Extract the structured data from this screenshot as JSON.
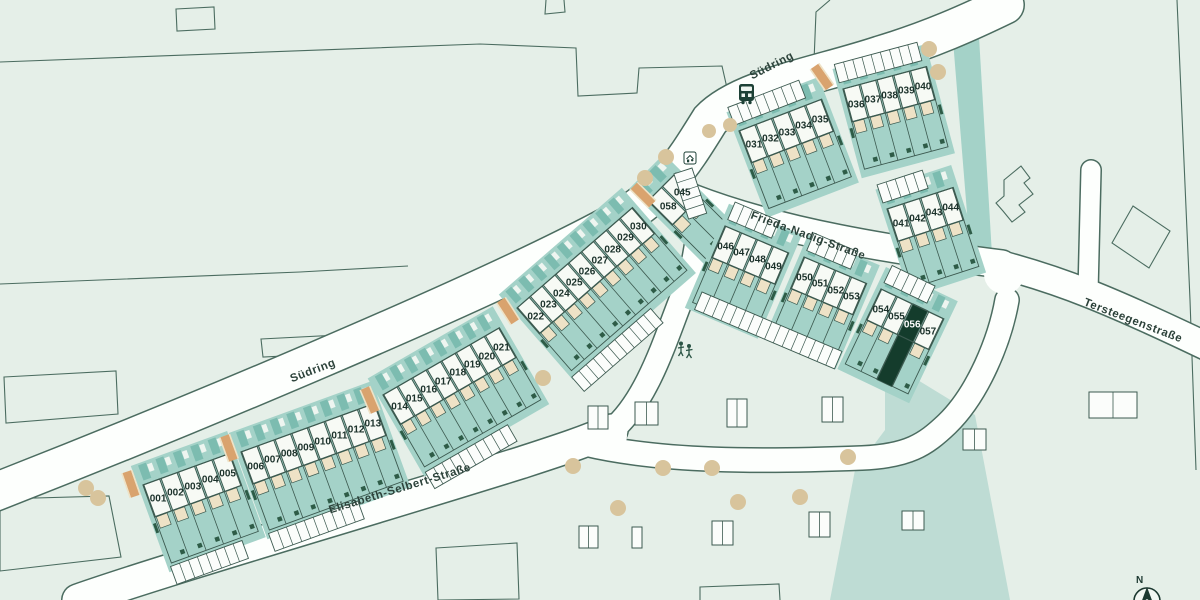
{
  "map": {
    "kind": "residential-site-plan"
  },
  "streets": [
    {
      "id": "suedring-west",
      "label": "Südring"
    },
    {
      "id": "suedring-north",
      "label": "Südring"
    },
    {
      "id": "elisabeth-selbert-strasse",
      "label": "Elisabeth-Selbert-Straße"
    },
    {
      "id": "frieda-nadig-strasse",
      "label": "Frieda-Nadig-Straße"
    },
    {
      "id": "tersteegenstrasse",
      "label": "Tersteegenstraße"
    }
  ],
  "blocks": [
    {
      "id": "block-a",
      "plots": [
        "001",
        "002",
        "003",
        "004",
        "005"
      ]
    },
    {
      "id": "block-b",
      "plots": [
        "006",
        "007",
        "008",
        "009",
        "010",
        "011",
        "012",
        "013"
      ]
    },
    {
      "id": "block-c",
      "plots": [
        "014",
        "015",
        "016",
        "017",
        "018",
        "019",
        "020",
        "021"
      ]
    },
    {
      "id": "block-d",
      "plots": [
        "022",
        "023",
        "024",
        "025",
        "026",
        "027",
        "028",
        "029",
        "030"
      ]
    },
    {
      "id": "block-e",
      "plots": [
        "058",
        "045"
      ]
    },
    {
      "id": "block-f",
      "plots": [
        "031",
        "032",
        "033",
        "034",
        "035"
      ]
    },
    {
      "id": "block-g",
      "plots": [
        "036",
        "037",
        "038",
        "039",
        "040"
      ]
    },
    {
      "id": "block-h",
      "plots": [
        "041",
        "042",
        "043",
        "044"
      ]
    },
    {
      "id": "block-i",
      "plots": [
        "046",
        "047",
        "048",
        "049"
      ]
    },
    {
      "id": "block-j",
      "plots": [
        "050",
        "051",
        "052",
        "053"
      ]
    },
    {
      "id": "block-k",
      "plots": [
        "054",
        "055",
        "056",
        "057"
      ]
    }
  ],
  "highlighted_plot": "056",
  "compass": {
    "label": "N"
  },
  "icons": [
    {
      "id": "bus-stop-icon"
    },
    {
      "id": "play-street-sign-icon"
    },
    {
      "id": "playground-icon"
    },
    {
      "id": "north-arrow-icon"
    }
  ],
  "colors": {
    "background": "#e5efe8",
    "block_teal": "#a4d2c8",
    "dark_teal": "#7cbcb0",
    "pale_teal": "#bedcd4",
    "house": "#f7faf5",
    "terrace": "#eee2c6",
    "outline": "#3c5a50",
    "casing": "#4b6c60",
    "accent_green": "#2e5c47",
    "highlight": "#143c2c",
    "road": "#fdfffd",
    "tree": "#d8c49c",
    "ramp": "#d9a36e"
  }
}
